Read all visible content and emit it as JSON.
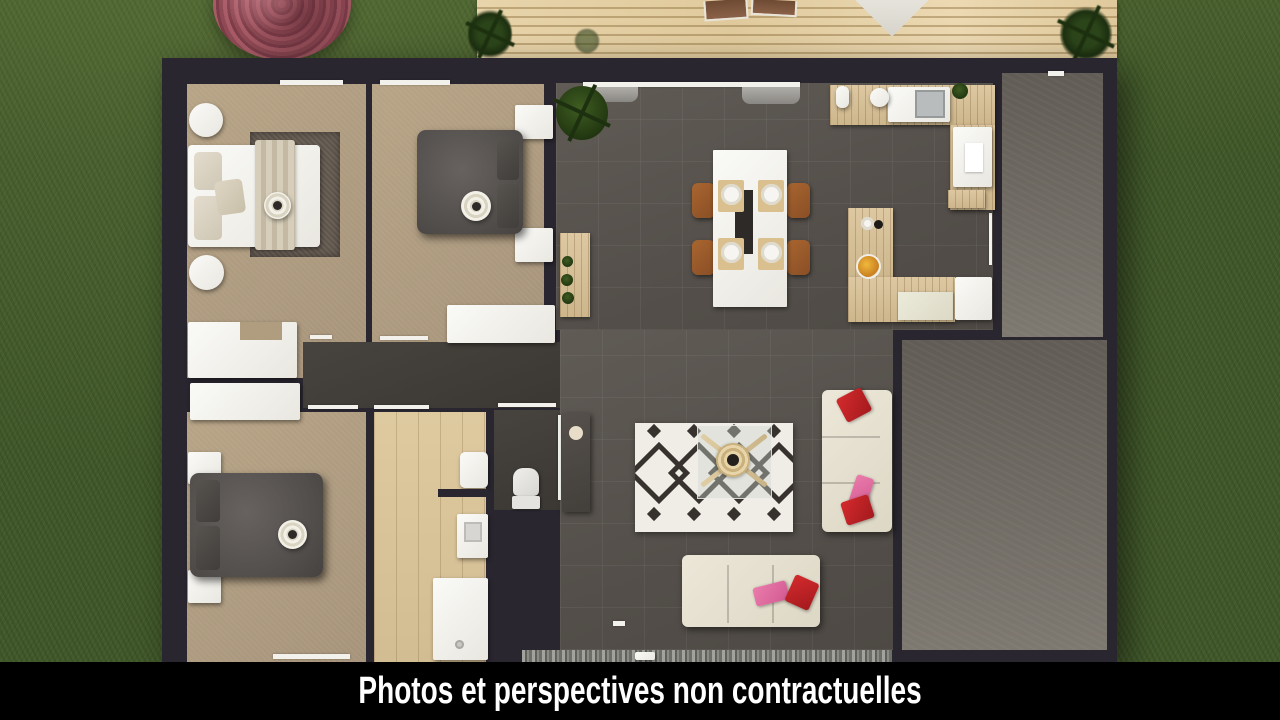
{
  "caption": {
    "text": "Photos et perspectives non contractuelles"
  },
  "scene": {
    "type": "3d-top-down-floor-plan-render",
    "colors": {
      "grass": "#41592a",
      "deck_wood": "#e3cfa5",
      "house_wall": "#2a2630",
      "bedroom_floor": "#b2a084",
      "bathroom_floor": "#d9c49c",
      "living_floor": "#59544f",
      "hallway_floor": "#3f3b37",
      "garage_floor": "#6e695f",
      "gravel": "#8d8d88",
      "area_rug_pattern": "#37322d",
      "bedroom_rug": "#6b6157",
      "sofa_cream": "#e8e3d4",
      "dining_chair_leather": "#9a5c30",
      "cushion_red": "#c32026",
      "cushion_pink": "#e06a9f",
      "flowering_bush": "#9c545e",
      "plants": "#223516",
      "caption_background": "#000000",
      "caption_text": "#ffffff"
    }
  }
}
